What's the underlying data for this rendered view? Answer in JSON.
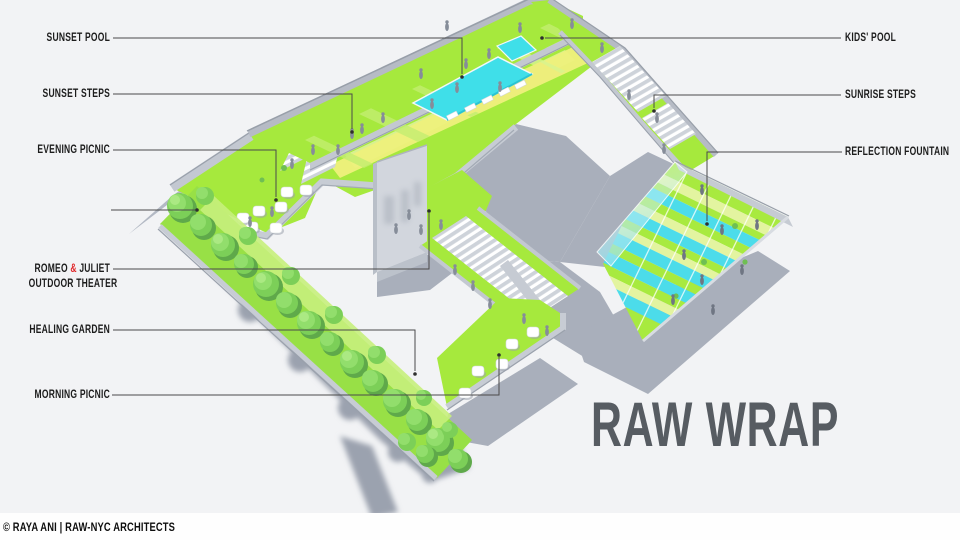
{
  "title": "RAW WRAP",
  "credit": "© RAYA ANI | RAW-NYC ARCHITECTS",
  "labels": {
    "sunset_pool": "SUNSET POOL",
    "sunset_steps": "SUNSET STEPS",
    "evening_picnic": "EVENING PICNIC",
    "romeo_pre": "ROMEO ",
    "romeo_amp": "&",
    "romeo_post": " JULIET",
    "romeo_line2": "OUTDOOR THEATER",
    "healing_garden": "HEALING GARDEN",
    "morning_picnic": "MORNING PICNIC",
    "kids_pool": "KIDS' POOL",
    "sunrise_steps": "SUNRISE STEPS",
    "reflection_fountain": "REFLECTION FOUNTAIN"
  },
  "colors": {
    "background": "#f2f3f5",
    "lawn_green": "#a6e93d",
    "pool_cyan": "#3fdfe9",
    "stripe_pale": "#e3f4a0",
    "path_yellow": "#eef07c",
    "shadow_gray": "#a9afbb",
    "parapet_gray": "#c7ccd4",
    "tree_green": "#7ccf58",
    "label_black": "#1c1c1c",
    "amp_red": "#e02528",
    "title_gray": "#575c62"
  }
}
